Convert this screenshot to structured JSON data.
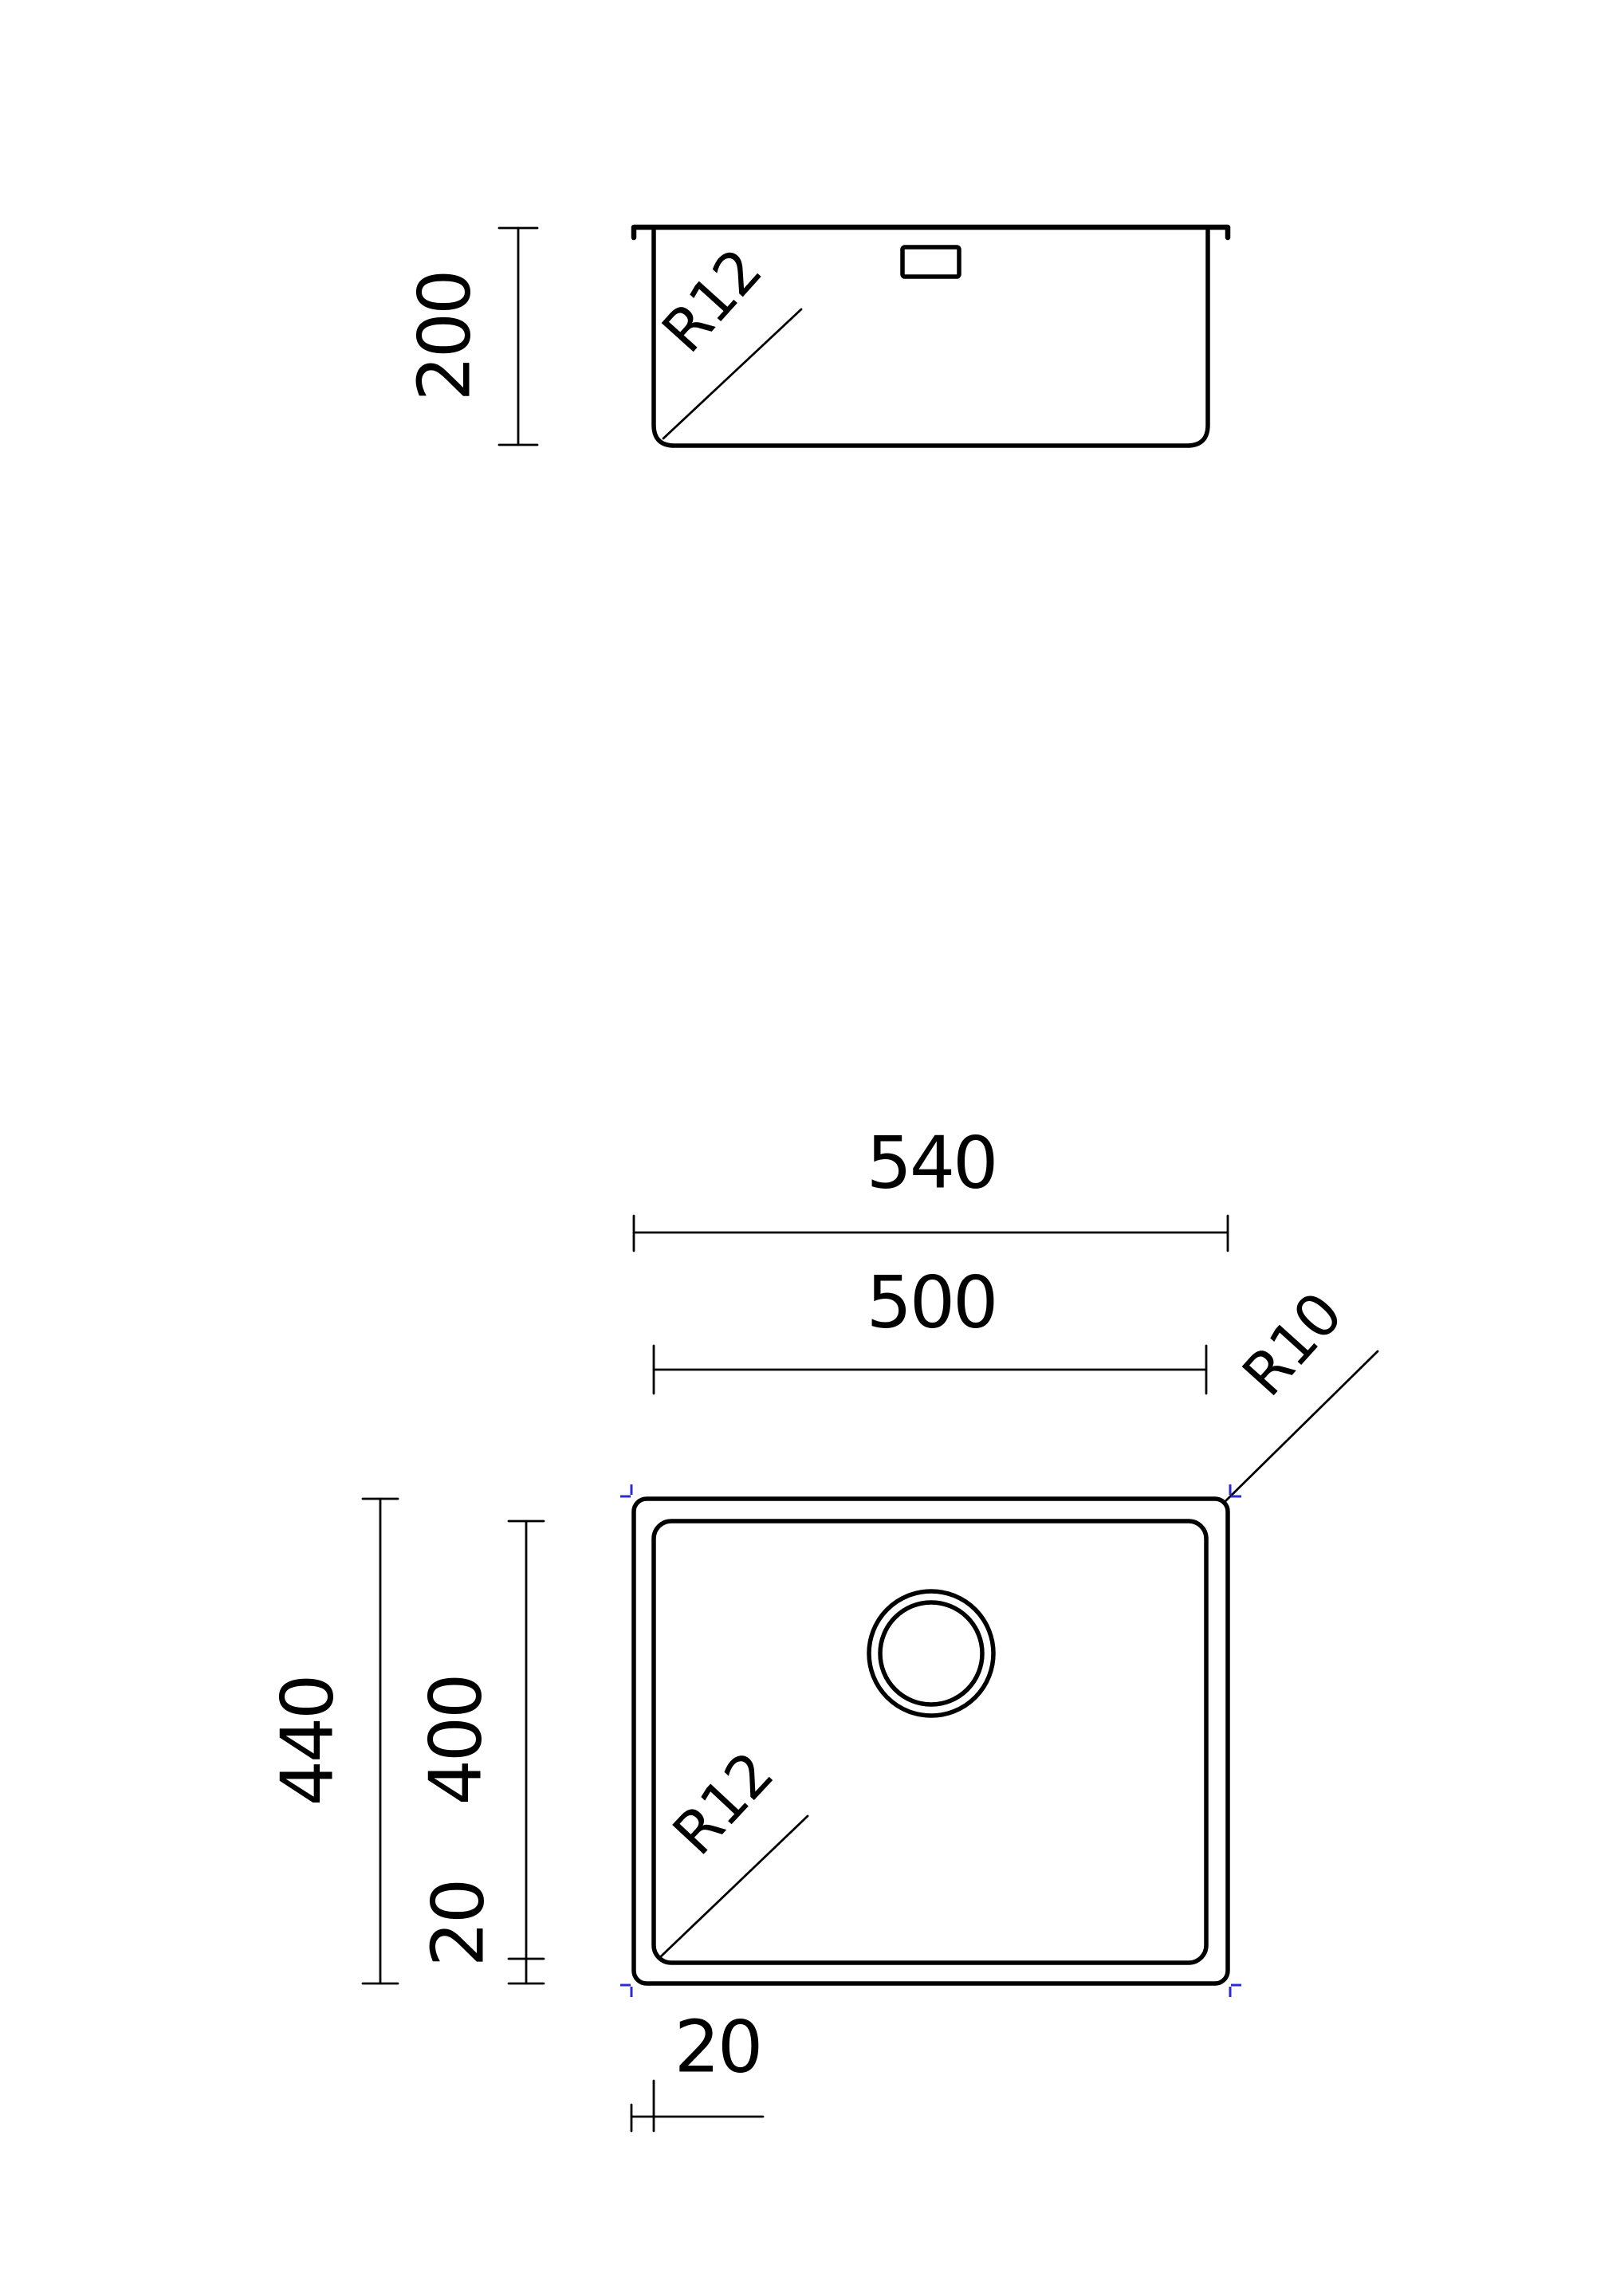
{
  "drawing": {
    "colors": {
      "line": "#000000",
      "marker": "#2b2bd6",
      "background": "#ffffff"
    },
    "side_view": {
      "depth": "200",
      "corner_radius": "R12"
    },
    "plan_view": {
      "outer_width": "540",
      "inner_width": "500",
      "outer_height": "440",
      "inner_height": "400",
      "bowl_inset_left": "20",
      "bowl_inset_bottom": "20",
      "outer_corner_radius": "R10",
      "inner_corner_radius": "R12"
    }
  }
}
